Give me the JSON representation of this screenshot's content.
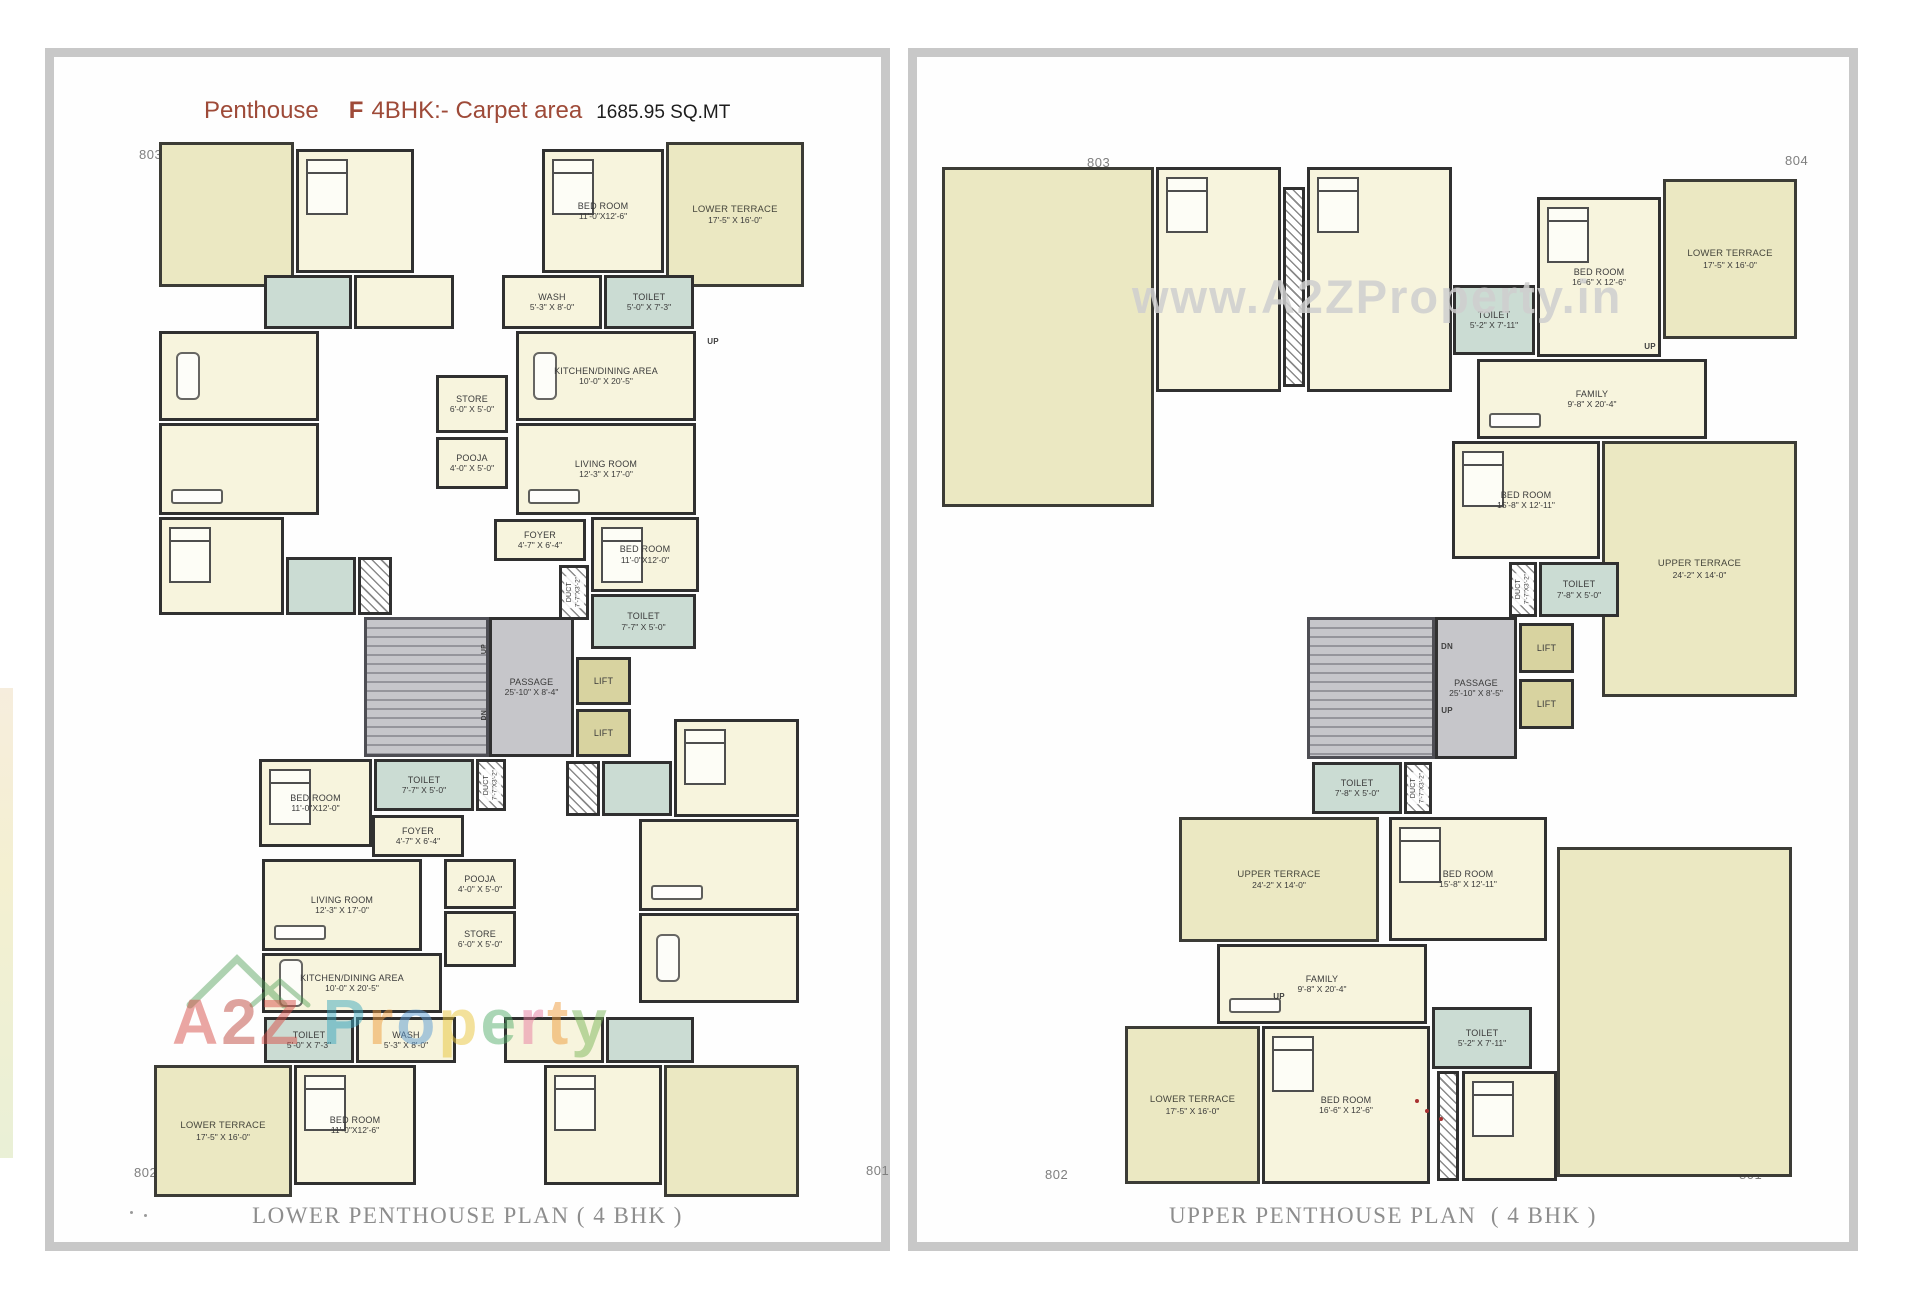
{
  "palette": {
    "wall": "#303030",
    "room_fill": "#f7f4dd",
    "terrace_fill": "#ebe8c2",
    "wet_fill": "#cbdcd3",
    "core_fill": "#c6c6ca",
    "lift_fill": "#d8d3a0",
    "title_accent": "#9e4a38",
    "caption_color": "#8d8d8d",
    "panel_border": "#c8c8c8"
  },
  "title": {
    "product": "Penthouse",
    "variant": "F",
    "spec": "4BHK:- Carpet area",
    "area": "1685.95 SQ.MT"
  },
  "plans": [
    {
      "id": "lower-penthouse",
      "caption": "LOWER PENTHOUSE PLAN ( 4 BHK )",
      "corners": {
        "top_left": "803",
        "top_right": "804",
        "bottom_left": "802",
        "bottom_right": "801"
      },
      "watermark": {
        "text": "A2Z Property",
        "letters": [
          {
            "ch": "A",
            "color": "#d8504a"
          },
          {
            "ch": "2",
            "color": "#c04a40"
          },
          {
            "ch": "Z",
            "color": "#d8504a"
          },
          {
            "ch": " ",
            "color": "#000000"
          },
          {
            "ch": "P",
            "color": "#3fa9bf"
          },
          {
            "ch": "r",
            "color": "#ef9b3c"
          },
          {
            "ch": "o",
            "color": "#5b9bd5"
          },
          {
            "ch": "p",
            "color": "#e9c63b"
          },
          {
            "ch": "e",
            "color": "#58b06e"
          },
          {
            "ch": "r",
            "color": "#e87ca0"
          },
          {
            "ch": "t",
            "color": "#ef9b3c"
          },
          {
            "ch": "y",
            "color": "#7cb85c"
          }
        ]
      },
      "rooms": [
        {
          "f": "terrace",
          "x": 105,
          "y": 85,
          "w": 135,
          "h": 145
        },
        {
          "f": "room",
          "x": 242,
          "y": 92,
          "w": 118,
          "h": 124,
          "furn": "bed"
        },
        {
          "n": "BED ROOM",
          "d": "11'-0\"X12'-6\"",
          "f": "room",
          "x": 488,
          "y": 92,
          "w": 122,
          "h": 124,
          "furn": "bed"
        },
        {
          "n": "LOWER TERRACE",
          "d": "17'-5\" X 16'-0\"",
          "f": "terrace",
          "x": 612,
          "y": 85,
          "w": 138,
          "h": 145
        },
        {
          "f": "wet",
          "x": 210,
          "y": 218,
          "w": 88,
          "h": 54
        },
        {
          "f": "room",
          "x": 300,
          "y": 218,
          "w": 100,
          "h": 54
        },
        {
          "n": "WASH",
          "d": "5'-3\" X 8'-0\"",
          "f": "room",
          "x": 448,
          "y": 218,
          "w": 100,
          "h": 54
        },
        {
          "n": "TOILET",
          "d": "5'-0\" X 7'-3\"",
          "f": "wet",
          "x": 550,
          "y": 218,
          "w": 90,
          "h": 54
        },
        {
          "f": "room",
          "x": 105,
          "y": 274,
          "w": 160,
          "h": 90,
          "furn": "table"
        },
        {
          "n": "KITCHEN/DINING AREA",
          "d": "10'-0\" X 20'-5\"",
          "f": "room",
          "x": 462,
          "y": 274,
          "w": 180,
          "h": 90,
          "furn": "table"
        },
        {
          "n": "STORE",
          "d": "6'-0\" X 5'-0\"",
          "f": "room",
          "x": 382,
          "y": 318,
          "w": 72,
          "h": 58
        },
        {
          "f": "room",
          "x": 105,
          "y": 366,
          "w": 160,
          "h": 92,
          "furn": "sofa"
        },
        {
          "n": "LIVING ROOM",
          "d": "12'-3\" X 17'-0\"",
          "f": "room",
          "x": 462,
          "y": 366,
          "w": 180,
          "h": 92,
          "furn": "sofa"
        },
        {
          "n": "POOJA",
          "d": "4'-0\" X 5'-0\"",
          "f": "room",
          "x": 382,
          "y": 380,
          "w": 72,
          "h": 52
        },
        {
          "n": "FOYER",
          "d": "4'-7\" X 6'-4\"",
          "f": "room",
          "x": 440,
          "y": 462,
          "w": 92,
          "h": 42
        },
        {
          "n": "BED ROOM",
          "d": "11'-0\"X12'-0\"",
          "f": "room",
          "x": 537,
          "y": 460,
          "w": 108,
          "h": 75,
          "furn": "bed"
        },
        {
          "n": "DUCT",
          "d": "7'-7\"X3'-2\"",
          "f": "duct",
          "x": 505,
          "y": 508,
          "w": 30,
          "h": 55,
          "v": true
        },
        {
          "n": "TOILET",
          "d": "7'-7\" X 5'-0\"",
          "f": "wet",
          "x": 537,
          "y": 537,
          "w": 105,
          "h": 55
        },
        {
          "f": "room",
          "x": 105,
          "y": 460,
          "w": 125,
          "h": 98,
          "furn": "bed"
        },
        {
          "f": "wet",
          "x": 232,
          "y": 500,
          "w": 70,
          "h": 58
        },
        {
          "f": "duct",
          "x": 304,
          "y": 500,
          "w": 34,
          "h": 58
        },
        {
          "f": "stairs",
          "x": 310,
          "y": 560,
          "w": 125,
          "h": 140
        },
        {
          "n": "PASSAGE",
          "d": "25'-10\" X 8'-4\"",
          "f": "core",
          "x": 435,
          "y": 560,
          "w": 85,
          "h": 140
        },
        {
          "n": "LIFT",
          "f": "lift",
          "x": 522,
          "y": 600,
          "w": 55,
          "h": 48
        },
        {
          "n": "LIFT",
          "f": "lift",
          "x": 522,
          "y": 652,
          "w": 55,
          "h": 48
        },
        {
          "n": "UP",
          "f": "mark",
          "x": 424,
          "y": 580,
          "w": 14,
          "h": 24,
          "v": true
        },
        {
          "n": "DN",
          "f": "mark",
          "x": 424,
          "y": 646,
          "w": 14,
          "h": 24,
          "v": true
        },
        {
          "n": "UP",
          "f": "mark",
          "x": 648,
          "y": 278,
          "w": 22,
          "h": 13
        },
        {
          "n": "TOILET",
          "d": "7'-7\" X 5'-0\"",
          "f": "wet",
          "x": 320,
          "y": 702,
          "w": 100,
          "h": 52
        },
        {
          "n": "DUCT",
          "d": "7'-7\"X3'-2\"",
          "f": "duct",
          "x": 422,
          "y": 702,
          "w": 30,
          "h": 52,
          "v": true
        },
        {
          "n": "BED ROOM",
          "d": "11'-0\"X12'-0\"",
          "f": "room",
          "x": 205,
          "y": 702,
          "w": 113,
          "h": 88,
          "furn": "bed"
        },
        {
          "n": "FOYER",
          "d": "4'-7\" X 6'-4\"",
          "f": "room",
          "x": 318,
          "y": 758,
          "w": 92,
          "h": 42
        },
        {
          "n": "POOJA",
          "d": "4'-0\" X 5'-0\"",
          "f": "room",
          "x": 390,
          "y": 802,
          "w": 72,
          "h": 50
        },
        {
          "n": "LIVING ROOM",
          "d": "12'-3\" X 17'-0\"",
          "f": "room",
          "x": 208,
          "y": 802,
          "w": 160,
          "h": 92,
          "furn": "sofa"
        },
        {
          "n": "STORE",
          "d": "6'-0\" X 5'-0\"",
          "f": "room",
          "x": 390,
          "y": 854,
          "w": 72,
          "h": 56
        },
        {
          "n": "KITCHEN/DINING AREA",
          "d": "10'-0\" X 20'-5\"",
          "f": "room",
          "x": 208,
          "y": 896,
          "w": 180,
          "h": 60,
          "furn": "table"
        },
        {
          "f": "room",
          "x": 585,
          "y": 762,
          "w": 160,
          "h": 92,
          "furn": "sofa"
        },
        {
          "f": "room",
          "x": 585,
          "y": 856,
          "w": 160,
          "h": 90,
          "furn": "table"
        },
        {
          "f": "room",
          "x": 620,
          "y": 662,
          "w": 125,
          "h": 98,
          "furn": "bed"
        },
        {
          "f": "wet",
          "x": 548,
          "y": 704,
          "w": 70,
          "h": 55
        },
        {
          "f": "duct",
          "x": 512,
          "y": 704,
          "w": 34,
          "h": 55
        },
        {
          "n": "TOILET",
          "d": "5'-0\" X 7'-3\"",
          "f": "wet",
          "x": 210,
          "y": 960,
          "w": 90,
          "h": 46
        },
        {
          "n": "WASH",
          "d": "5'-3\" X 8'-0\"",
          "f": "room",
          "x": 302,
          "y": 960,
          "w": 100,
          "h": 46
        },
        {
          "f": "room",
          "x": 450,
          "y": 960,
          "w": 100,
          "h": 46
        },
        {
          "f": "wet",
          "x": 552,
          "y": 960,
          "w": 88,
          "h": 46
        },
        {
          "n": "LOWER TERRACE",
          "d": "17'-5\" X 16'-0\"",
          "f": "terrace",
          "x": 100,
          "y": 1008,
          "w": 138,
          "h": 132
        },
        {
          "n": "BED ROOM",
          "d": "11'-0\"X12'-6\"",
          "f": "room",
          "x": 240,
          "y": 1008,
          "w": 122,
          "h": 120,
          "furn": "bed"
        },
        {
          "f": "room",
          "x": 490,
          "y": 1008,
          "w": 118,
          "h": 120,
          "furn": "bed"
        },
        {
          "f": "terrace",
          "x": 610,
          "y": 1008,
          "w": 135,
          "h": 132
        }
      ]
    },
    {
      "id": "upper-penthouse",
      "caption": "UPPER PENTHOUSE PLAN  ( 4 BHK )",
      "corners": {
        "top_left": "803",
        "top_right": "804",
        "bottom_left": "802",
        "bottom_right": "801"
      },
      "watermark": {
        "text": "www.A2ZProperty.in"
      },
      "rooms": [
        {
          "f": "terrace",
          "x": 25,
          "y": 110,
          "w": 212,
          "h": 340
        },
        {
          "f": "room",
          "x": 239,
          "y": 110,
          "w": 125,
          "h": 225,
          "furn": "bed"
        },
        {
          "f": "duct",
          "x": 366,
          "y": 130,
          "w": 22,
          "h": 200
        },
        {
          "f": "room",
          "x": 390,
          "y": 110,
          "w": 145,
          "h": 225,
          "furn": "bed"
        },
        {
          "n": "TOILET",
          "d": "5'-2\" X 7'-11\"",
          "f": "wet",
          "x": 536,
          "y": 228,
          "w": 82,
          "h": 70
        },
        {
          "n": "BED ROOM",
          "d": "16'-6\" X 12'-6\"",
          "f": "room",
          "x": 620,
          "y": 140,
          "w": 124,
          "h": 160,
          "furn": "bed"
        },
        {
          "n": "LOWER TERRACE",
          "d": "17'-5\" X 16'-0\"",
          "f": "terrace",
          "x": 746,
          "y": 122,
          "w": 134,
          "h": 160
        },
        {
          "n": "FAMILY",
          "d": "9'-8\" X 20'-4\"",
          "f": "room",
          "x": 560,
          "y": 302,
          "w": 230,
          "h": 80,
          "furn": "sofa"
        },
        {
          "n": "UP",
          "f": "mark",
          "x": 722,
          "y": 283,
          "w": 22,
          "h": 13
        },
        {
          "n": "BED ROOM",
          "d": "15'-8\" X 12'-11\"",
          "f": "room",
          "x": 535,
          "y": 384,
          "w": 148,
          "h": 118,
          "furn": "bed"
        },
        {
          "n": "UPPER TERRACE",
          "d": "24'-2\" X 14'-0\"",
          "f": "terrace",
          "x": 685,
          "y": 384,
          "w": 195,
          "h": 256
        },
        {
          "n": "DUCT",
          "d": "7'-7\"X3'-2\"",
          "f": "duct",
          "x": 592,
          "y": 505,
          "w": 28,
          "h": 55,
          "v": true
        },
        {
          "n": "TOILET",
          "d": "7'-8\" X 5'-0\"",
          "f": "wet",
          "x": 622,
          "y": 505,
          "w": 80,
          "h": 55
        },
        {
          "f": "stairs",
          "x": 390,
          "y": 560,
          "w": 128,
          "h": 142
        },
        {
          "n": "PASSAGE",
          "d": "25'-10\" X 8'-5\"",
          "f": "core",
          "x": 518,
          "y": 560,
          "w": 82,
          "h": 142
        },
        {
          "n": "LIFT",
          "f": "lift",
          "x": 602,
          "y": 566,
          "w": 55,
          "h": 50
        },
        {
          "n": "LIFT",
          "f": "lift",
          "x": 602,
          "y": 622,
          "w": 55,
          "h": 50
        },
        {
          "n": "DN",
          "f": "mark",
          "x": 520,
          "y": 584,
          "w": 20,
          "h": 12
        },
        {
          "n": "UP",
          "f": "mark",
          "x": 520,
          "y": 648,
          "w": 20,
          "h": 12
        },
        {
          "n": "TOILET",
          "d": "7'-8\" X 5'-0\"",
          "f": "wet",
          "x": 395,
          "y": 705,
          "w": 90,
          "h": 52
        },
        {
          "n": "DUCT",
          "d": "7'-7\"X3'-2\"",
          "f": "duct",
          "x": 487,
          "y": 705,
          "w": 28,
          "h": 52,
          "v": true
        },
        {
          "n": "UPPER TERRACE",
          "d": "24'-2\" X 14'-0\"",
          "f": "terrace",
          "x": 262,
          "y": 760,
          "w": 200,
          "h": 125
        },
        {
          "n": "BED ROOM",
          "d": "15'-8\" X 12'-11\"",
          "f": "room",
          "x": 472,
          "y": 760,
          "w": 158,
          "h": 124,
          "furn": "bed"
        },
        {
          "n": "FAMILY",
          "d": "9'-8\" X 20'-4\"",
          "f": "room",
          "x": 300,
          "y": 887,
          "w": 210,
          "h": 80,
          "furn": "sofa"
        },
        {
          "n": "UP",
          "f": "mark",
          "x": 352,
          "y": 934,
          "w": 20,
          "h": 12
        },
        {
          "n": "BED ROOM",
          "d": "16'-6\" X 12'-6\"",
          "f": "room",
          "x": 345,
          "y": 969,
          "w": 168,
          "h": 158,
          "furn": "bed"
        },
        {
          "n": "TOILET",
          "d": "5'-2\" X 7'-11\"",
          "f": "wet",
          "x": 515,
          "y": 950,
          "w": 100,
          "h": 62
        },
        {
          "n": "LOWER TERRACE",
          "d": "17'-5\" X 16'-0\"",
          "f": "terrace",
          "x": 208,
          "y": 969,
          "w": 135,
          "h": 158
        },
        {
          "f": "terrace",
          "x": 640,
          "y": 790,
          "w": 235,
          "h": 330
        },
        {
          "f": "room",
          "x": 545,
          "y": 1014,
          "w": 95,
          "h": 110,
          "furn": "bed"
        },
        {
          "f": "duct",
          "x": 520,
          "y": 1014,
          "w": 22,
          "h": 110
        }
      ]
    }
  ]
}
